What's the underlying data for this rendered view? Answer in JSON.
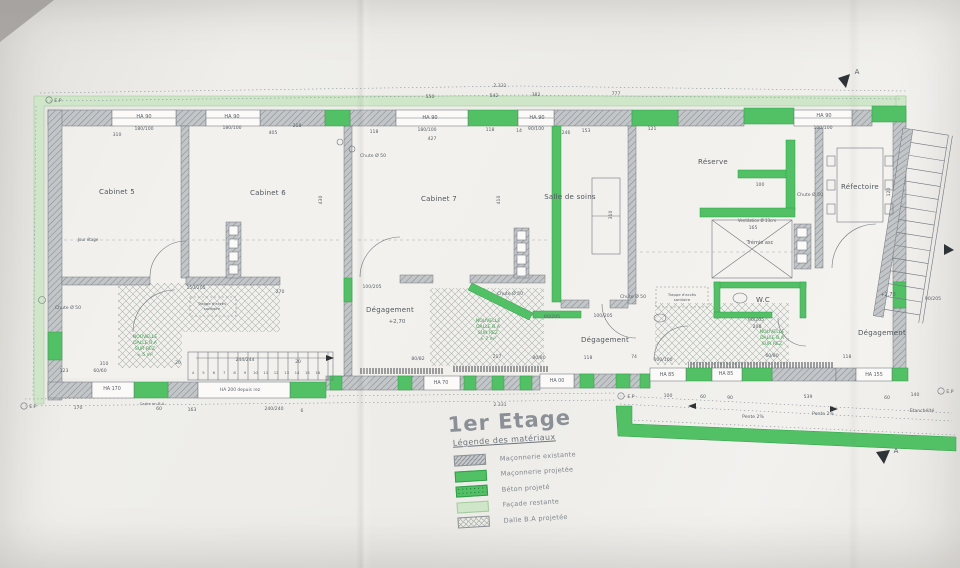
{
  "sheet": {
    "title": "1er Etage",
    "legend_title": "Légende des matériaux"
  },
  "legend": {
    "items": [
      {
        "label": "Maçonnerie existante",
        "type": "existing"
      },
      {
        "label": "Maçonnerie projetée",
        "type": "projected"
      },
      {
        "label": "Béton projeté",
        "type": "beton"
      },
      {
        "label": "Façade restante",
        "type": "facade"
      },
      {
        "label": "Dalle B.A projetée",
        "type": "dalle"
      }
    ]
  },
  "colors": {
    "projected_green": "#52c166",
    "facade_green": "#cfe6c8",
    "existing_gray": "#c6c9cc",
    "line": "#70767c"
  },
  "plan": {
    "rooms": [
      {
        "x": 117,
        "y": 194,
        "t": "Cabinet 5"
      },
      {
        "x": 268,
        "y": 195,
        "t": "Cabinet 6"
      },
      {
        "x": 439,
        "y": 201,
        "t": "Cabinet 7"
      },
      {
        "x": 570,
        "y": 199,
        "t": "Salle de soins"
      },
      {
        "x": 713,
        "y": 164,
        "t": "Réserve"
      },
      {
        "x": 860,
        "y": 189,
        "t": "Réfectoire"
      },
      {
        "x": 390,
        "y": 312,
        "t": "Dégagement"
      },
      {
        "x": 605,
        "y": 342,
        "t": "Dégagement"
      },
      {
        "x": 882,
        "y": 335,
        "t": "Dégagement"
      },
      {
        "x": 763,
        "y": 302,
        "t": "W.C"
      }
    ],
    "stair_numbers": [
      "4",
      "5",
      "6",
      "7",
      "8",
      "9",
      "10",
      "11",
      "12",
      "13",
      "14",
      "15",
      "16"
    ],
    "labels": [
      {
        "x": 500,
        "y": 87,
        "t": "2.331"
      },
      {
        "x": 430,
        "y": 98,
        "t": "550"
      },
      {
        "x": 494,
        "y": 97,
        "t": "542"
      },
      {
        "x": 536,
        "y": 96,
        "t": "382"
      },
      {
        "x": 616,
        "y": 95,
        "t": "777"
      },
      {
        "x": 144,
        "y": 118,
        "t": "HA 90",
        "s": 5
      },
      {
        "x": 144,
        "y": 130,
        "t": "180/100"
      },
      {
        "x": 232,
        "y": 118,
        "t": "HA 90",
        "s": 5
      },
      {
        "x": 232,
        "y": 129,
        "t": "180/100"
      },
      {
        "x": 117,
        "y": 136,
        "t": "310"
      },
      {
        "x": 273,
        "y": 134,
        "t": "405"
      },
      {
        "x": 297,
        "y": 127,
        "t": "218"
      },
      {
        "x": 374,
        "y": 133,
        "t": "118"
      },
      {
        "x": 432,
        "y": 140,
        "t": "427"
      },
      {
        "x": 430,
        "y": 119,
        "t": "HA 90",
        "s": 5
      },
      {
        "x": 427,
        "y": 131,
        "t": "180/100"
      },
      {
        "x": 490,
        "y": 131,
        "t": "118"
      },
      {
        "x": 519,
        "y": 132,
        "t": "14"
      },
      {
        "x": 537,
        "y": 119,
        "t": "HA 90",
        "s": 5
      },
      {
        "x": 536,
        "y": 130,
        "t": "90/100"
      },
      {
        "x": 566,
        "y": 134,
        "t": "246"
      },
      {
        "x": 586,
        "y": 132,
        "t": "153"
      },
      {
        "x": 652,
        "y": 130,
        "t": "121"
      },
      {
        "x": 824,
        "y": 117,
        "t": "HA 90",
        "s": 5
      },
      {
        "x": 823,
        "y": 129,
        "t": "100/100"
      },
      {
        "x": 373,
        "y": 157,
        "t": "Chute Ø 50"
      },
      {
        "x": 322,
        "y": 200,
        "t": "430",
        "r": 1
      },
      {
        "x": 500,
        "y": 200,
        "t": "410",
        "r": 1
      },
      {
        "x": 612,
        "y": 215,
        "t": "310",
        "r": 1
      },
      {
        "x": 890,
        "y": 192,
        "t": "120",
        "r": 1
      },
      {
        "x": 88,
        "y": 241,
        "t": "Jour étage",
        "s": 4
      },
      {
        "x": 810,
        "y": 196,
        "t": "Chute Ø 50"
      },
      {
        "x": 760,
        "y": 186,
        "t": "100"
      },
      {
        "x": 757,
        "y": 222,
        "t": "Ventilation Ø 33cm",
        "s": 4
      },
      {
        "x": 753,
        "y": 229,
        "t": "165"
      },
      {
        "x": 760,
        "y": 244,
        "t": "Trémie asc",
        "s": 5
      },
      {
        "x": 682,
        "y": 296,
        "t": "Trappe d'accès",
        "s": 3.8
      },
      {
        "x": 682,
        "y": 301,
        "t": "sanitaire",
        "s": 3.8
      },
      {
        "x": 212,
        "y": 305,
        "t": "Trappe d'accès",
        "s": 3.8
      },
      {
        "x": 212,
        "y": 310,
        "t": "sanitaire",
        "s": 3.8
      },
      {
        "x": 397,
        "y": 323,
        "t": "+2,70",
        "s": 5.5
      },
      {
        "x": 888,
        "y": 296,
        "t": "+2,70",
        "s": 5
      },
      {
        "x": 68,
        "y": 309,
        "t": "Chute Ø 50"
      },
      {
        "x": 510,
        "y": 295,
        "t": "Chute Ø 50"
      },
      {
        "x": 633,
        "y": 298,
        "t": "Chute Ø 50"
      },
      {
        "x": 145,
        "y": 338,
        "t": "NOUVELLE",
        "g": 1
      },
      {
        "x": 145,
        "y": 344,
        "t": "DALLE B.A",
        "g": 1
      },
      {
        "x": 145,
        "y": 350,
        "t": "SUR REZ",
        "g": 1
      },
      {
        "x": 145,
        "y": 356,
        "t": "± 5 m²",
        "g": 1
      },
      {
        "x": 488,
        "y": 322,
        "t": "NOUVELLE",
        "g": 1
      },
      {
        "x": 488,
        "y": 328,
        "t": "DALLE B.A",
        "g": 1
      },
      {
        "x": 488,
        "y": 334,
        "t": "SUR REZ",
        "g": 1
      },
      {
        "x": 488,
        "y": 340,
        "t": "± 7 m²",
        "g": 1
      },
      {
        "x": 772,
        "y": 333,
        "t": "NOUVELLE",
        "g": 1
      },
      {
        "x": 772,
        "y": 339,
        "t": "DALLE B.A",
        "g": 1
      },
      {
        "x": 772,
        "y": 345,
        "t": "SUR REZ",
        "g": 1
      },
      {
        "x": 196,
        "y": 289,
        "t": "150/205"
      },
      {
        "x": 280,
        "y": 293,
        "t": "270"
      },
      {
        "x": 372,
        "y": 288,
        "t": "100/205"
      },
      {
        "x": 552,
        "y": 318,
        "t": "60/205"
      },
      {
        "x": 603,
        "y": 317,
        "t": "100/205"
      },
      {
        "x": 756,
        "y": 321,
        "t": "90/205"
      },
      {
        "x": 757,
        "y": 328,
        "t": "208"
      },
      {
        "x": 933,
        "y": 300,
        "t": "90/205"
      },
      {
        "x": 64,
        "y": 372,
        "t": "123"
      },
      {
        "x": 100,
        "y": 372,
        "t": "60/60"
      },
      {
        "x": 104,
        "y": 365,
        "t": "310"
      },
      {
        "x": 178,
        "y": 364,
        "t": "20"
      },
      {
        "x": 245,
        "y": 361,
        "t": "244/244"
      },
      {
        "x": 298,
        "y": 363,
        "t": "20"
      },
      {
        "x": 112,
        "y": 390,
        "t": "HA 170",
        "s": 4.8
      },
      {
        "x": 240,
        "y": 391,
        "t": "HA 200 depuis rez",
        "s": 4.4
      },
      {
        "x": 441,
        "y": 384,
        "t": "HA 70",
        "s": 4.8
      },
      {
        "x": 557,
        "y": 382,
        "t": "HA 00",
        "s": 4.8
      },
      {
        "x": 667,
        "y": 376,
        "t": "HA 85",
        "s": 4.8
      },
      {
        "x": 726,
        "y": 375,
        "t": "HA 85",
        "s": 4.8
      },
      {
        "x": 874,
        "y": 376,
        "t": "HA 155",
        "s": 4.8
      },
      {
        "x": 152,
        "y": 405,
        "t": "Cadre en B.A",
        "s": 3.8
      },
      {
        "x": 78,
        "y": 409,
        "t": "170"
      },
      {
        "x": 159,
        "y": 410,
        "t": "60"
      },
      {
        "x": 192,
        "y": 411,
        "t": "163"
      },
      {
        "x": 274,
        "y": 410,
        "t": "240/240"
      },
      {
        "x": 302,
        "y": 412,
        "t": "6"
      },
      {
        "x": 500,
        "y": 406,
        "t": "2.331"
      },
      {
        "x": 418,
        "y": 360,
        "t": "80/82"
      },
      {
        "x": 497,
        "y": 358,
        "t": "217"
      },
      {
        "x": 539,
        "y": 359,
        "t": "80/80"
      },
      {
        "x": 588,
        "y": 359,
        "t": "118"
      },
      {
        "x": 634,
        "y": 358,
        "t": "74"
      },
      {
        "x": 663,
        "y": 361,
        "t": "100/100"
      },
      {
        "x": 772,
        "y": 357,
        "t": "60/80"
      },
      {
        "x": 847,
        "y": 358,
        "t": "118"
      },
      {
        "x": 668,
        "y": 397,
        "t": "100"
      },
      {
        "x": 703,
        "y": 398,
        "t": "60"
      },
      {
        "x": 730,
        "y": 399,
        "t": "90"
      },
      {
        "x": 808,
        "y": 398,
        "t": "539"
      },
      {
        "x": 887,
        "y": 399,
        "t": "60"
      },
      {
        "x": 915,
        "y": 396,
        "t": "140"
      },
      {
        "x": 753,
        "y": 418,
        "t": "Pente 2%"
      },
      {
        "x": 823,
        "y": 415,
        "t": "Pente 2%"
      },
      {
        "x": 922,
        "y": 412,
        "t": "Etanchéité"
      },
      {
        "x": 58,
        "y": 102,
        "t": "E.P"
      },
      {
        "x": 33,
        "y": 408,
        "t": "E.P"
      },
      {
        "x": 631,
        "y": 398,
        "t": "E.P"
      },
      {
        "x": 950,
        "y": 393,
        "t": "E.P"
      },
      {
        "x": 857,
        "y": 74,
        "t": "A",
        "s": 7
      },
      {
        "x": 896,
        "y": 453,
        "t": "A",
        "s": 7
      }
    ]
  }
}
